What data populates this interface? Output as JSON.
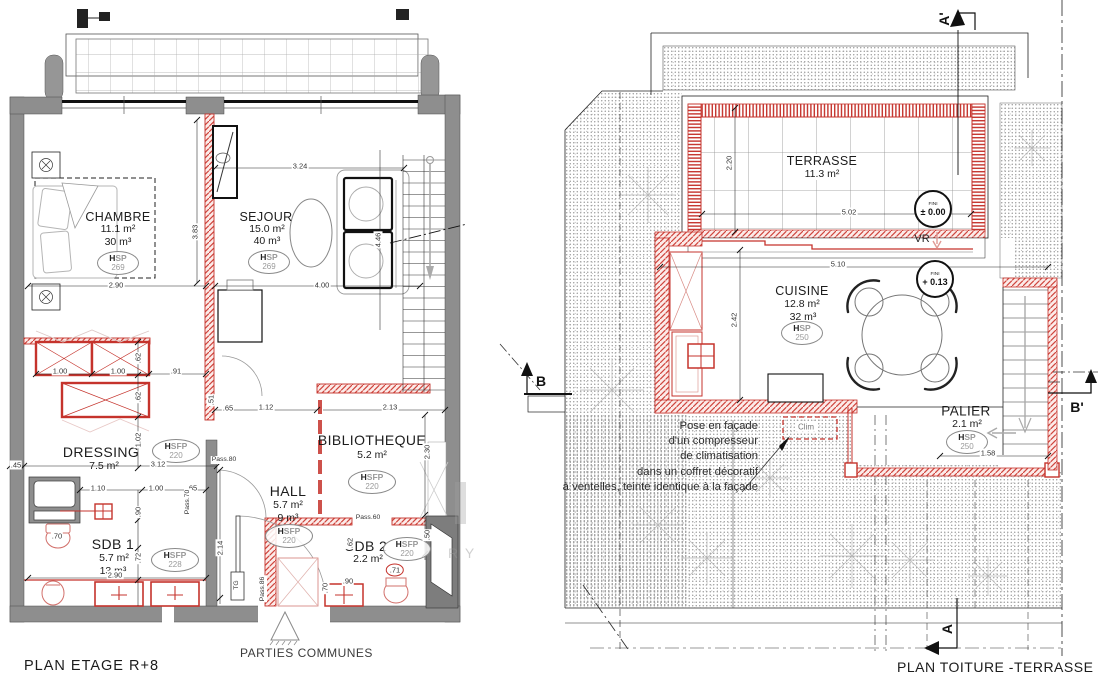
{
  "plan_left": {
    "title": "PLAN ETAGE R+8",
    "commons_label": "PARTIES COMMUNES",
    "rooms": {
      "chambre": {
        "name": "CHAMBRE",
        "area": "11.1 m²",
        "volume": "30 m³",
        "badge": {
          "h": "H",
          "rest": "SP",
          "value": "269"
        }
      },
      "sejour": {
        "name": "SEJOUR",
        "area": "15.0 m²",
        "volume": "40 m³",
        "badge": {
          "h": "H",
          "rest": "SP",
          "value": "269"
        }
      },
      "dressing": {
        "name": "DRESSING",
        "area": "7.5 m²",
        "badge": {
          "h": "H",
          "rest": "SFP",
          "value": "220"
        }
      },
      "hall": {
        "name": "HALL",
        "area": "5.7 m²",
        "volume": "9 m³",
        "badge": {
          "h": "H",
          "rest": "SFP",
          "value": "220"
        }
      },
      "bibliotheque": {
        "name": "BIBLIOTHEQUE",
        "area": "5.2 m²",
        "badge": {
          "h": "H",
          "rest": "SFP",
          "value": "220"
        }
      },
      "sdb1": {
        "name": "SDB 1",
        "area": "5.7 m²",
        "volume": "13 m³",
        "badge": {
          "h": "H",
          "rest": "SFP",
          "value": "228"
        }
      },
      "sdb2": {
        "name": "SDB 2",
        "area": "2.2 m²",
        "badge": {
          "h": "H",
          "rest": "SFP",
          "value": "220"
        }
      }
    },
    "dims": [
      "3.24",
      "3.83",
      "2.90",
      "4.00",
      "4.46",
      "1.00",
      "1.00",
      ".91",
      ".62",
      ".62",
      "1.02",
      ".45",
      "3.12",
      "1.10",
      "1.00",
      ".65",
      ".90",
      ".70",
      ".72",
      "2.90",
      "2.14",
      "1.12",
      "2.13",
      "2.30",
      ".50",
      ".62",
      ".70",
      ".90",
      ".71",
      ".51",
      ".65"
    ],
    "passages": [
      "Pass.80",
      "Pass.70",
      "Pass.86",
      "Pass.60",
      "TG"
    ]
  },
  "plan_right": {
    "title": "PLAN TOITURE -TERRASSE",
    "rooms": {
      "terrasse": {
        "name": "TERRASSE",
        "area": "11.3 m²"
      },
      "cuisine": {
        "name": "CUISINE",
        "area": "12.8 m²",
        "volume": "32 m³",
        "badge": {
          "h": "H",
          "rest": "SP",
          "value": "250"
        }
      },
      "palier": {
        "name": "PALIER",
        "area": "2.1 m²",
        "badge": {
          "h": "H",
          "rest": "SP",
          "value": "250"
        }
      }
    },
    "levels": [
      {
        "label": "FINI",
        "value": "± 0.00"
      },
      {
        "label": "FINI",
        "value": "+ 0.13"
      }
    ],
    "vr_label": "VR",
    "clim_label": "Clim",
    "annotation": [
      "Pose en façade",
      "d'un compresseur",
      "de climatisation",
      "dans un coffret décoratif",
      "à ventelles, teinte identique à la façade"
    ],
    "dims": [
      "2.20",
      "5.02",
      "5.10",
      "2.42",
      "1.58"
    ],
    "markers": {
      "a_prime": "A'",
      "b": "B",
      "b_prime": "B'",
      "a": "A"
    }
  },
  "watermark": {
    "text": "RY"
  },
  "colors": {
    "wall_gray": "#8e8e8e",
    "red": "#c5332c",
    "line": "#1b1b1b"
  }
}
